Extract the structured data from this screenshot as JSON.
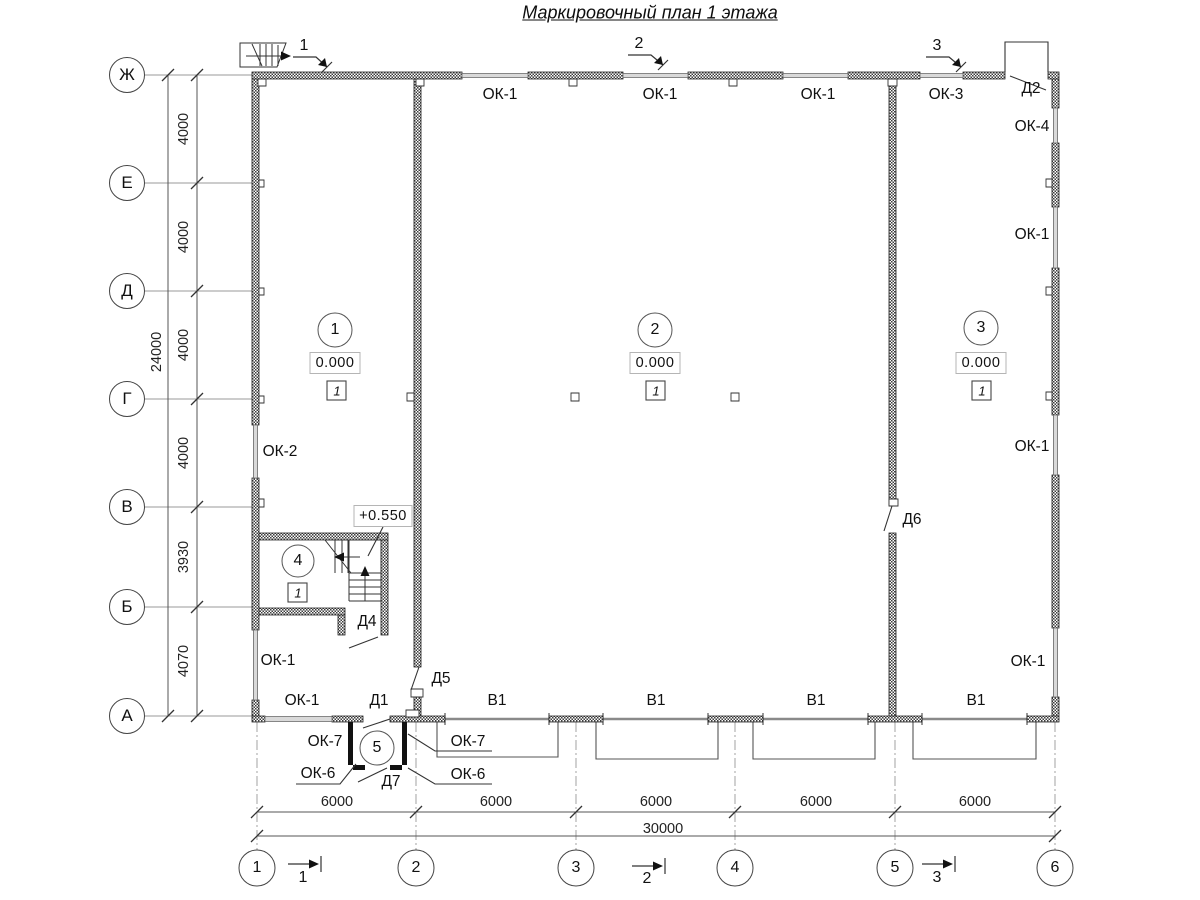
{
  "title": "Маркировочный план 1 этажа",
  "axes": {
    "rows": [
      {
        "label": "Ж",
        "y": 75
      },
      {
        "label": "Е",
        "y": 183
      },
      {
        "label": "Д",
        "y": 291
      },
      {
        "label": "Г",
        "y": 399
      },
      {
        "label": "В",
        "y": 507
      },
      {
        "label": "Б",
        "y": 607
      },
      {
        "label": "А",
        "y": 716
      }
    ],
    "cols": [
      {
        "label": "1",
        "x": 257
      },
      {
        "label": "2",
        "x": 416
      },
      {
        "label": "3",
        "x": 576
      },
      {
        "label": "4",
        "x": 735
      },
      {
        "label": "5",
        "x": 895
      },
      {
        "label": "6",
        "x": 1055
      }
    ]
  },
  "dimensions": {
    "left_segments": [
      {
        "text": "4000",
        "x": 184,
        "y": 129
      },
      {
        "text": "4000",
        "x": 184,
        "y": 237
      },
      {
        "text": "4000",
        "x": 184,
        "y": 345
      },
      {
        "text": "4000",
        "x": 184,
        "y": 453
      },
      {
        "text": "3930",
        "x": 184,
        "y": 557
      },
      {
        "text": "4070",
        "x": 184,
        "y": 661
      }
    ],
    "left_total": {
      "text": "24000",
      "x": 157,
      "y": 352
    },
    "bottom_segments": [
      {
        "text": "6000",
        "x": 337,
        "y": 802
      },
      {
        "text": "6000",
        "x": 496,
        "y": 802
      },
      {
        "text": "6000",
        "x": 656,
        "y": 802
      },
      {
        "text": "6000",
        "x": 816,
        "y": 802
      },
      {
        "text": "6000",
        "x": 975,
        "y": 802
      }
    ],
    "bottom_total": {
      "text": "30000",
      "x": 663,
      "y": 829
    }
  },
  "section_marks": {
    "top": [
      {
        "text": "1",
        "x": 304,
        "y": 46
      },
      {
        "text": "2",
        "x": 639,
        "y": 44
      },
      {
        "text": "3",
        "x": 937,
        "y": 46
      }
    ],
    "bottom": [
      {
        "text": "1",
        "x": 303,
        "y": 878
      },
      {
        "text": "2",
        "x": 647,
        "y": 879
      },
      {
        "text": "3",
        "x": 937,
        "y": 878
      }
    ]
  },
  "rooms": [
    {
      "number": "1",
      "cx": 335,
      "cy": 330,
      "r": 17,
      "elevation": "0.000",
      "ex": 335,
      "ey": 363,
      "type_mark": "1",
      "tx": 337,
      "ty": 391
    },
    {
      "number": "2",
      "cx": 655,
      "cy": 330,
      "r": 17,
      "elevation": "0.000",
      "ex": 655,
      "ey": 363,
      "type_mark": "1",
      "tx": 656,
      "ty": 391
    },
    {
      "number": "3",
      "cx": 981,
      "cy": 328,
      "r": 17,
      "elevation": "0.000",
      "ex": 981,
      "ey": 363,
      "type_mark": "1",
      "tx": 982,
      "ty": 391
    },
    {
      "number": "4",
      "cx": 298,
      "cy": 561,
      "r": 16,
      "type_mark": "1",
      "tx": 298,
      "ty": 593
    },
    {
      "number": "5",
      "cx": 377,
      "cy": 748,
      "r": 17
    }
  ],
  "upper_elevation": {
    "text": "+0.550",
    "x": 383,
    "y": 516
  },
  "marks": [
    {
      "text": "ОК-1",
      "x": 500,
      "y": 95
    },
    {
      "text": "ОК-1",
      "x": 660,
      "y": 95
    },
    {
      "text": "ОК-1",
      "x": 818,
      "y": 95
    },
    {
      "text": "ОК-3",
      "x": 946,
      "y": 95
    },
    {
      "text": "Д2",
      "x": 1031,
      "y": 89
    },
    {
      "text": "ОК-4",
      "x": 1032,
      "y": 127
    },
    {
      "text": "ОК-1",
      "x": 1032,
      "y": 235
    },
    {
      "text": "ОК-1",
      "x": 1032,
      "y": 447
    },
    {
      "text": "ОК-1",
      "x": 1028,
      "y": 662
    },
    {
      "text": "ОК-2",
      "x": 280,
      "y": 452
    },
    {
      "text": "Д6",
      "x": 912,
      "y": 520
    },
    {
      "text": "ОК-1",
      "x": 278,
      "y": 661
    },
    {
      "text": "ОК-1",
      "x": 302,
      "y": 701
    },
    {
      "text": "Д1",
      "x": 379,
      "y": 701
    },
    {
      "text": "Д5",
      "x": 441,
      "y": 679
    },
    {
      "text": "Д4",
      "x": 367,
      "y": 622
    },
    {
      "text": "В1",
      "x": 497,
      "y": 701
    },
    {
      "text": "В1",
      "x": 656,
      "y": 701
    },
    {
      "text": "В1",
      "x": 816,
      "y": 701
    },
    {
      "text": "В1",
      "x": 976,
      "y": 701
    },
    {
      "text": "ОК-7",
      "x": 325,
      "y": 742
    },
    {
      "text": "ОК-7",
      "x": 468,
      "y": 742
    },
    {
      "text": "ОК-6",
      "x": 318,
      "y": 774
    },
    {
      "text": "ОК-6",
      "x": 468,
      "y": 775
    },
    {
      "text": "Д7",
      "x": 391,
      "y": 782
    }
  ]
}
